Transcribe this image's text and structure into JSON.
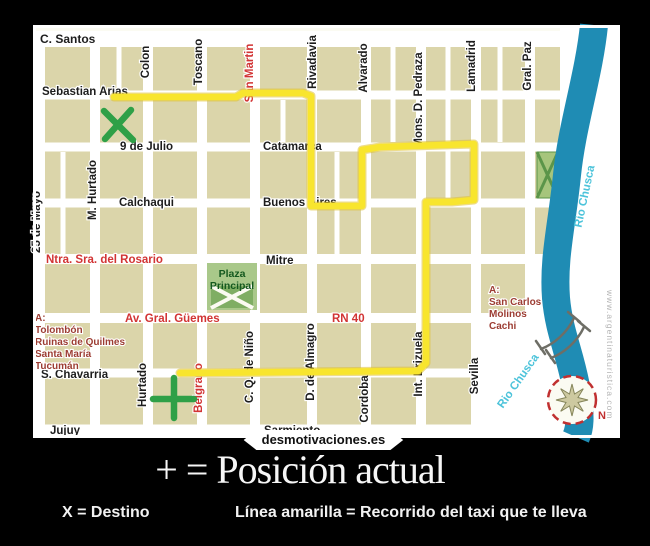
{
  "caption": {
    "title": "+ = Posición actual",
    "legend_x": "X = Destino",
    "legend_line": "Línea amarilla = Recorrido del taxi que te lleva",
    "site": "desmotivaciones.es"
  },
  "map": {
    "frame": {
      "x": 33,
      "y": 25,
      "w": 587,
      "h": 413
    },
    "inner": {
      "x": 35,
      "y": 27,
      "w": 583,
      "h": 410
    },
    "colors": {
      "paper": "#fbfbf2",
      "block": "#dbd5aa",
      "street": "#ffffff",
      "ink": "#1d1d1d",
      "red": "#d23434",
      "maroon": "#9c3c32",
      "plaza_bg": "#a9c88a",
      "plaza_dark": "#7fae63",
      "plaza_text": "#14591f",
      "park": "#a6c57c",
      "park_line": "#5b9549",
      "river": "#1f8cb4",
      "river_text": "#4cc3da",
      "route": "#f8e52e",
      "route_edge": "#dfc02b",
      "mark": "#2fa047",
      "compass": "#c03030",
      "star_fill": "#cdc9a0",
      "star_edge": "#85855a",
      "gray": "#b5b5b5",
      "bridge": "#6e6e66"
    },
    "grid": {
      "blocks_rect": [
        36,
        31,
        524,
        405
      ],
      "h_bands": [
        [
          39,
          16
        ],
        [
          95,
          9
        ],
        [
          147,
          9
        ],
        [
          203,
          9
        ],
        [
          259,
          10
        ],
        [
          318,
          10
        ],
        [
          373,
          9
        ],
        [
          430,
          11
        ]
      ],
      "v_bands": [
        40,
        95,
        148,
        202,
        255,
        312,
        366,
        421,
        476,
        530
      ],
      "v_band_w": 10,
      "alleys": [
        [
          63,
          152,
          258
        ],
        [
          119,
          46,
          90
        ],
        [
          283,
          100,
          142
        ],
        [
          337,
          152,
          254
        ],
        [
          393,
          46,
          142
        ],
        [
          448,
          46,
          198
        ],
        [
          500,
          46,
          142
        ]
      ],
      "white_areas": [
        [
          560,
          27,
          58,
          410
        ],
        [
          478,
          313,
          140,
          124
        ],
        [
          528,
          254,
          90,
          184
        ]
      ]
    },
    "labels_h": [
      {
        "t": "C. Santos",
        "x": 40,
        "y": 43,
        "c": "ink",
        "s": 12
      },
      {
        "t": "Sebastian Arias",
        "x": 42,
        "y": 95,
        "c": "ink",
        "s": 11.5
      },
      {
        "t": "9 de Julio",
        "x": 120,
        "y": 150,
        "c": "ink",
        "s": 11.5
      },
      {
        "t": "Catamarca",
        "x": 263,
        "y": 150,
        "c": "ink",
        "s": 11.5
      },
      {
        "t": "Calchaqui",
        "x": 119,
        "y": 206,
        "c": "ink",
        "s": 11.5
      },
      {
        "t": "Buenos Aires",
        "x": 263,
        "y": 206,
        "c": "ink",
        "s": 11.5
      },
      {
        "t": "Ntra. Sra. del Rosario",
        "x": 46,
        "y": 263,
        "c": "red",
        "s": 11.5
      },
      {
        "t": "Mitre",
        "x": 266,
        "y": 264,
        "c": "ink",
        "s": 11.5
      },
      {
        "t": "Av. Gral. Güemes",
        "x": 125,
        "y": 322,
        "c": "red",
        "s": 11.5
      },
      {
        "t": "RN 40",
        "x": 332,
        "y": 322,
        "c": "red",
        "s": 11.5
      },
      {
        "t": "S. Chavarria",
        "x": 41,
        "y": 378,
        "c": "ink",
        "s": 11.5
      },
      {
        "t": "Jujuy",
        "x": 50,
        "y": 434,
        "c": "ink",
        "s": 11.5
      },
      {
        "t": "Sarmiento",
        "x": 264,
        "y": 434,
        "c": "ink",
        "s": 11.5
      }
    ],
    "labels_v": [
      {
        "t": "25 de Mayo",
        "x": 40,
        "y": 222,
        "c": "ink"
      },
      {
        "t": "M. Hurtado",
        "x": 96,
        "y": 190,
        "c": "ink"
      },
      {
        "t": "Colon",
        "x": 149,
        "y": 62,
        "c": "ink"
      },
      {
        "t": "Toscano",
        "x": 202,
        "y": 62,
        "c": "ink"
      },
      {
        "t": "San Martin",
        "x": 253,
        "y": 73,
        "c": "red"
      },
      {
        "t": "Rivadavia",
        "x": 316,
        "y": 62,
        "c": "ink"
      },
      {
        "t": "Alvarado",
        "x": 367,
        "y": 68,
        "c": "ink"
      },
      {
        "t": "Mons. D. Pedraza",
        "x": 422,
        "y": 100,
        "c": "ink"
      },
      {
        "t": "Lamadrid",
        "x": 475,
        "y": 66,
        "c": "ink"
      },
      {
        "t": "Gral. Paz",
        "x": 531,
        "y": 66,
        "c": "ink"
      },
      {
        "t": "Hurtado",
        "x": 146,
        "y": 385,
        "c": "ink"
      },
      {
        "t": "Belgrano",
        "x": 202,
        "y": 388,
        "c": "red"
      },
      {
        "t": "C. Q. de Niño",
        "x": 253,
        "y": 367,
        "c": "ink"
      },
      {
        "t": "D. de Almagro",
        "x": 314,
        "y": 362,
        "c": "ink"
      },
      {
        "t": "Cordoba",
        "x": 368,
        "y": 399,
        "c": "ink"
      },
      {
        "t": "Int. Brizuela",
        "x": 422,
        "y": 364,
        "c": "ink"
      },
      {
        "t": "Sevilla",
        "x": 478,
        "y": 376,
        "c": "ink"
      }
    ],
    "list_left": {
      "x": 35,
      "y": 321,
      "lh": 12,
      "lines": [
        "A:",
        "Tolombón",
        "Ruinas de Quilmes",
        "Santa María",
        "Tucumán"
      ]
    },
    "list_right": {
      "x": 489,
      "y": 293,
      "lh": 12,
      "lines": [
        "A:",
        "San Carlos",
        "Molinos",
        "Cachi"
      ]
    },
    "plaza": {
      "x": 207,
      "y": 263,
      "w": 50,
      "h": 47,
      "label": [
        "Plaza",
        "Principal"
      ]
    },
    "park": {
      "x": 537,
      "y": 152,
      "w": 21,
      "h": 46
    },
    "river_path": "M 594 25 C 589 75 572 125 567 175 C 562 225 553 258 556 298 C 559 333 571 355 577 392 C 581 417 580 428 576 437",
    "river_w": 28,
    "river_labels": [
      {
        "t": "Rio Chusca",
        "x": 588,
        "y": 197,
        "r": -78
      },
      {
        "t": "Rio Chusca",
        "x": 521,
        "y": 383,
        "r": -55
      }
    ],
    "bridge": [
      "M 541 349 C 554 344 567 333 574 318",
      "M 551 358 C 564 353 577 342 584 327",
      "M 536 341 L 545 354",
      "M 568 312 L 580 322",
      "M 546 350 L 555 363",
      "M 578 321 L 590 331"
    ],
    "route": [
      [
        114,
        97
      ],
      [
        236,
        97
      ],
      [
        243,
        93
      ],
      [
        303,
        93
      ],
      [
        311,
        96
      ],
      [
        311,
        206
      ],
      [
        362,
        206
      ],
      [
        362,
        150
      ],
      [
        380,
        147
      ],
      [
        474,
        144
      ],
      [
        474,
        200
      ],
      [
        452,
        202
      ],
      [
        426,
        202
      ],
      [
        426,
        363
      ],
      [
        418,
        371
      ],
      [
        180,
        373
      ]
    ],
    "x_mark": [
      [
        104,
        111,
        133,
        140
      ],
      [
        131,
        110,
        105,
        139
      ]
    ],
    "plus_mark": [
      [
        174,
        378,
        174,
        418
      ],
      [
        153,
        399,
        194,
        399
      ]
    ],
    "compass": {
      "cx": 572,
      "cy": 400,
      "r": 24,
      "n": "N"
    },
    "watermark": {
      "t": "www.argentinaturistica.com",
      "x": 607,
      "y": 290,
      "r": 90
    }
  }
}
